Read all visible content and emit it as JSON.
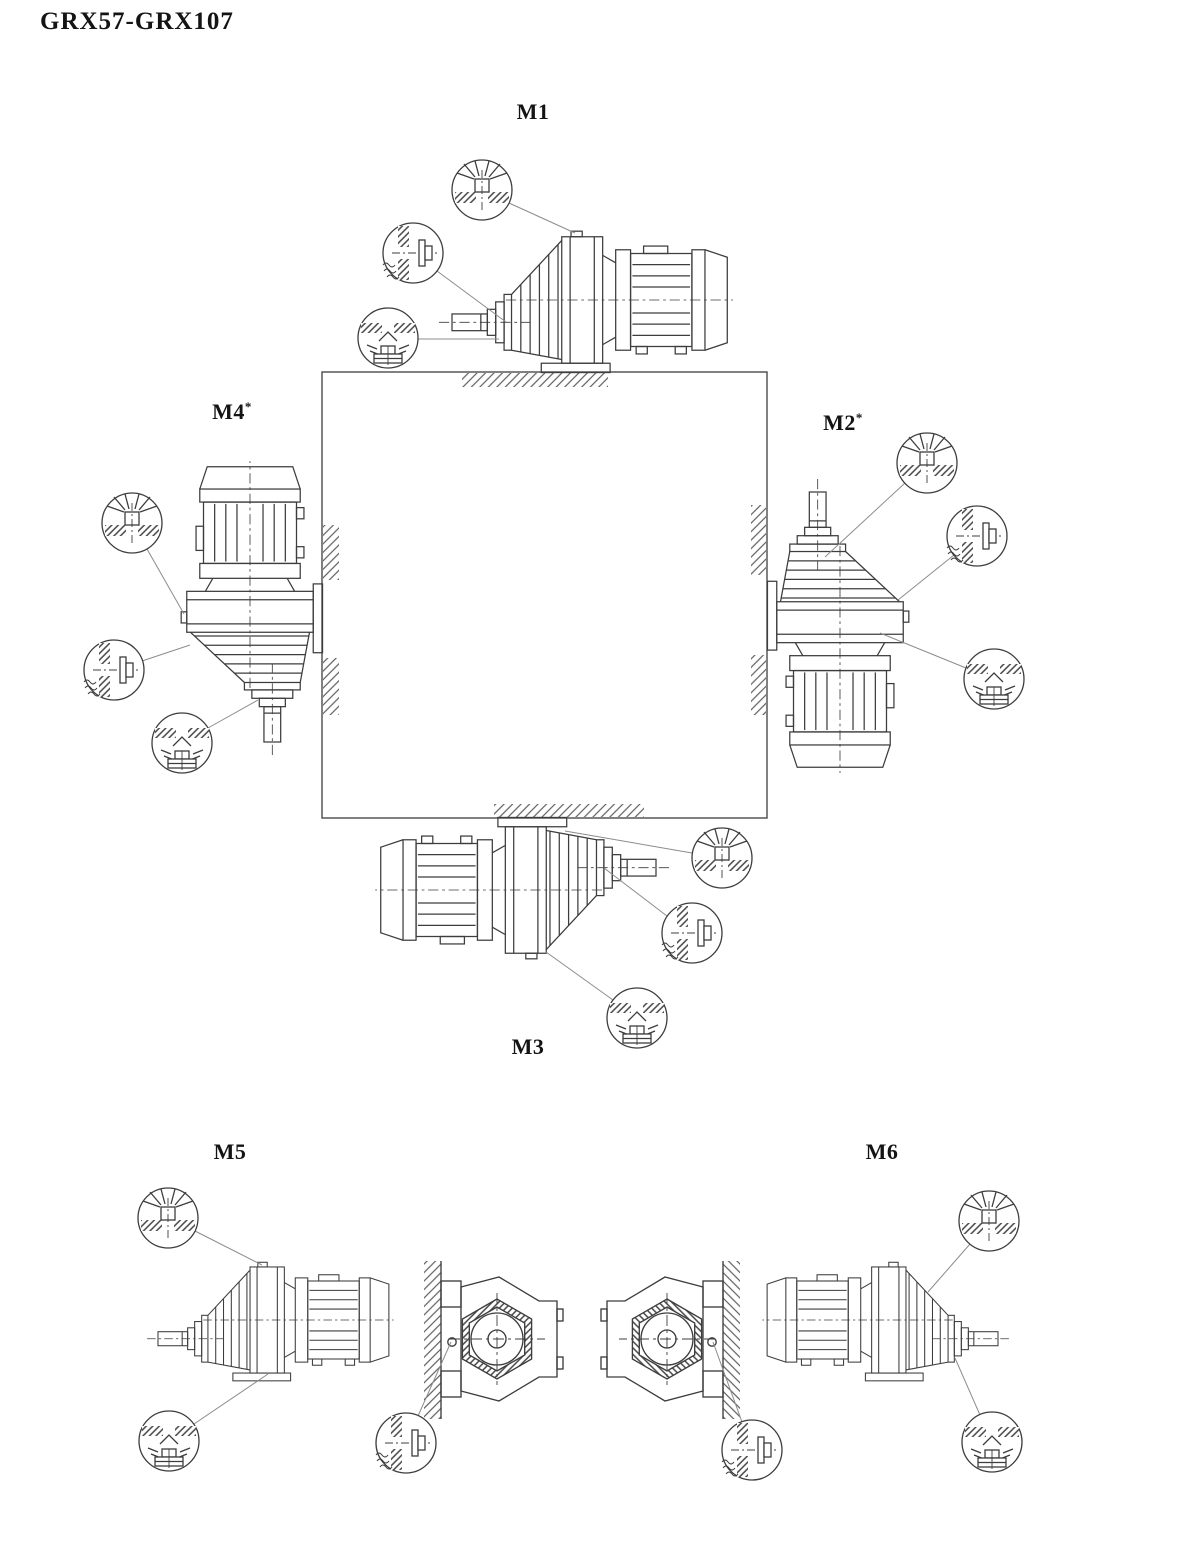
{
  "document": {
    "title": "GRX57-GRX107"
  },
  "positions": {
    "m1": {
      "label": "M1",
      "suffix": ""
    },
    "m2": {
      "label": "M2",
      "suffix": "*"
    },
    "m3": {
      "label": "M3",
      "suffix": ""
    },
    "m4": {
      "label": "M4",
      "suffix": "*"
    },
    "m5": {
      "label": "M5",
      "suffix": ""
    },
    "m6": {
      "label": "M6",
      "suffix": ""
    }
  },
  "plug_symbols": {
    "breather": "breather-plug",
    "level": "oil-level-plug",
    "drain": "oil-drain-plug"
  },
  "colors": {
    "line": "#3d3d3d",
    "leader": "#8c8c8c",
    "text": "#141414",
    "background": "#ffffff"
  }
}
